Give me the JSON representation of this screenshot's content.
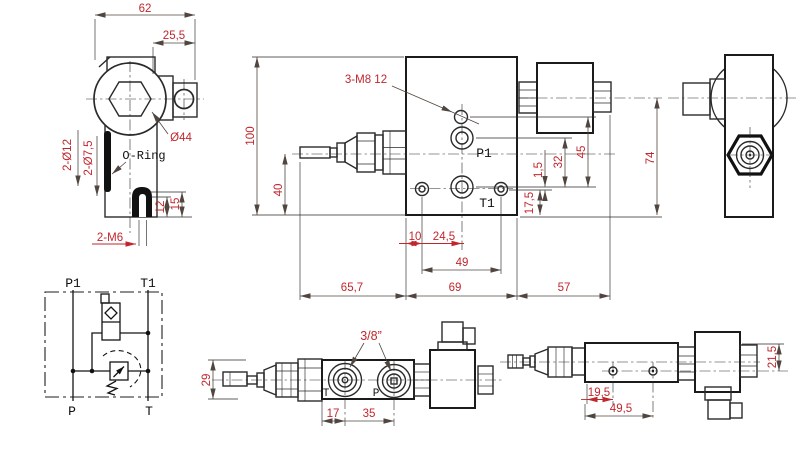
{
  "colors": {
    "background": "#ffffff",
    "outline": "#1b1b1b",
    "dimension_text": "#c0272d"
  },
  "views": {
    "top_left": {
      "dims": {
        "width": "62",
        "flange_offset": "25,5",
        "knob_diameter": "Ø44",
        "oring_label": "O-Ring",
        "holes_12": "2-Ø12",
        "holes_7_5": "2-Ø7,5",
        "slot_12": "12",
        "slot_15": "15",
        "thread_m6": "2-M6"
      }
    },
    "main": {
      "thread_note": "3-M8 12",
      "ports": {
        "p1": "P1",
        "t1": "T1"
      },
      "dims": {
        "height_100": "100",
        "axis_40": "40",
        "d_10": "10",
        "d_24_5": "24,5",
        "d_49": "49",
        "d_65_7": "65,7",
        "d_69": "69",
        "d_57": "57",
        "d_1_5": "1,5",
        "d_32": "32",
        "d_45": "45",
        "d_17_5": "17,5",
        "d_74": "74"
      }
    },
    "schematic": {
      "ports": {
        "p1": "P1",
        "t1": "T1",
        "p": "P",
        "t": "T"
      }
    },
    "bottom_front": {
      "port_size": "3/8”",
      "ports": {
        "t": "T",
        "p": "P"
      },
      "dims": {
        "height_29": "29",
        "d_17": "17",
        "d_35": "35"
      }
    },
    "bottom_side": {
      "dims": {
        "d_19_5": "19,5",
        "d_49_5": "49,5",
        "d_21_5": "21,5"
      }
    }
  }
}
